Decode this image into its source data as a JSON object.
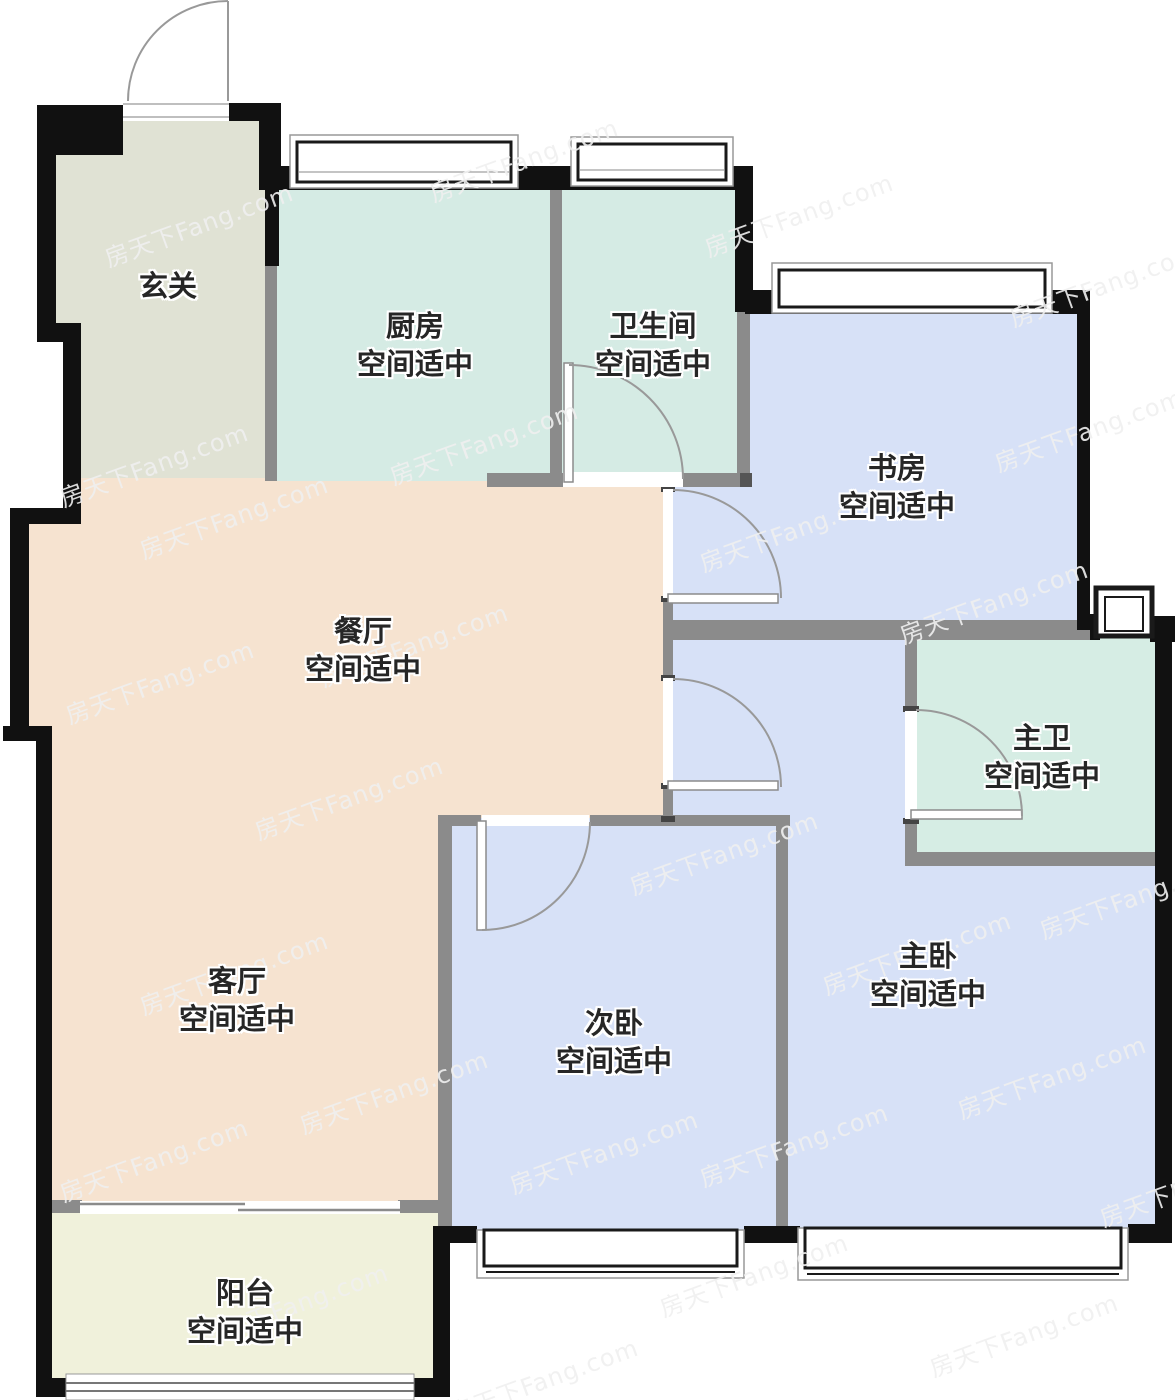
{
  "watermark": {
    "text": "房天下Fang.com",
    "color": "#f0f0f0"
  },
  "rooms": [
    {
      "id": "entry",
      "name": "玄关",
      "status": "",
      "color": "#e0e2d4"
    },
    {
      "id": "kitchen",
      "name": "厨房",
      "status": "空间适中",
      "color": "#d5ebe4"
    },
    {
      "id": "bathroom",
      "name": "卫生间",
      "status": "空间适中",
      "color": "#d5ebe4"
    },
    {
      "id": "study",
      "name": "书房",
      "status": "空间适中",
      "color": "#d7e1f7"
    },
    {
      "id": "dining",
      "name": "餐厅",
      "status": "空间适中",
      "color": "#f6e3d0"
    },
    {
      "id": "master-bath",
      "name": "主卫",
      "status": "空间适中",
      "color": "#d6ede4"
    },
    {
      "id": "living",
      "name": "客厅",
      "status": "空间适中",
      "color": "#f6e3d0"
    },
    {
      "id": "second-bedroom",
      "name": "次卧",
      "status": "空间适中",
      "color": "#d7e1f7"
    },
    {
      "id": "master-bedroom",
      "name": "主卧",
      "status": "空间适中",
      "color": "#d7e1f7"
    },
    {
      "id": "balcony",
      "name": "阳台",
      "status": "空间适中",
      "color": "#f0f1db"
    }
  ],
  "colors": {
    "exterior_wall": "#111111",
    "interior_wall": "#8b8b8b",
    "door_arc": "#999999",
    "window_frame": "#1a1a1a",
    "background": "#ffffff"
  }
}
